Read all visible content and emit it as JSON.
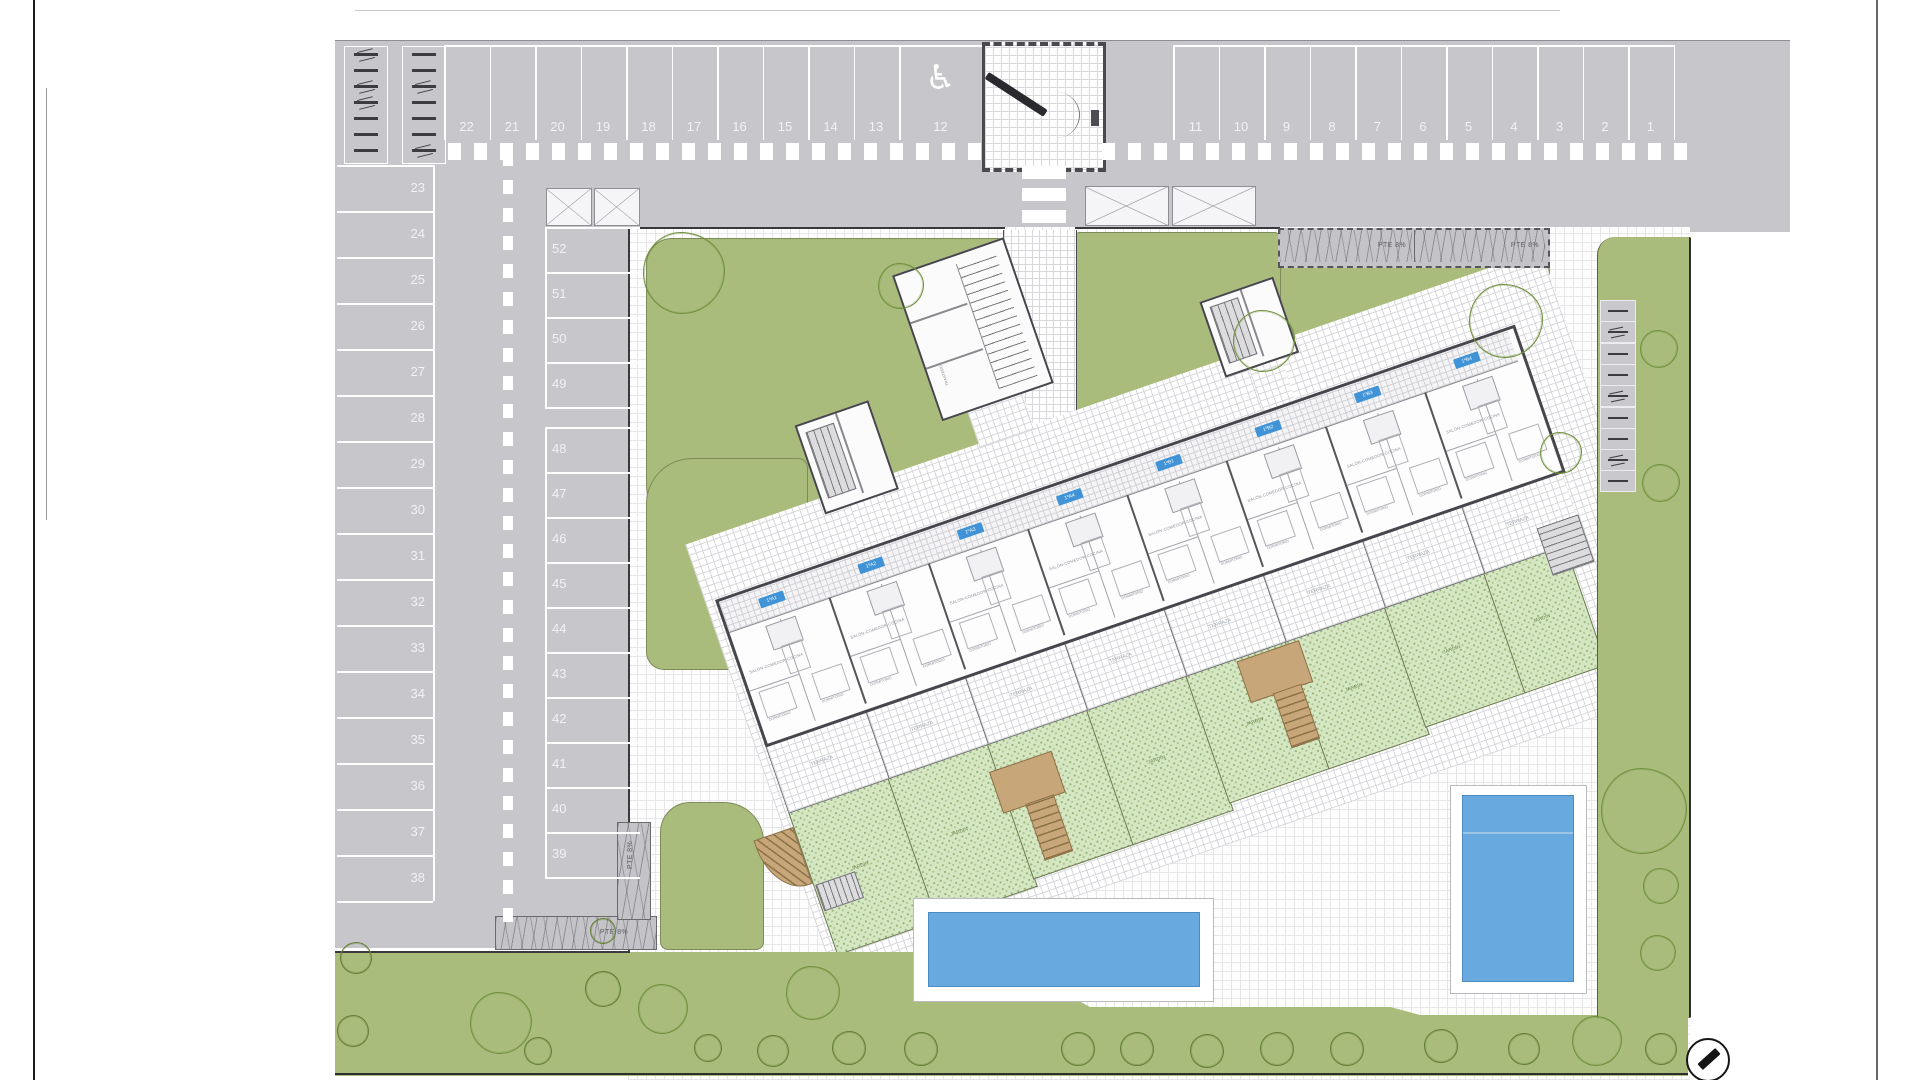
{
  "drawing": {
    "parking": {
      "top_left_numbers": [
        "22",
        "21",
        "20",
        "19",
        "18",
        "17",
        "16",
        "15",
        "14",
        "13"
      ],
      "accessible_number": "12",
      "accessible_icon": "♿",
      "top_right_numbers": [
        "11",
        "10",
        "9",
        "8",
        "7",
        "6",
        "5",
        "4",
        "3",
        "2",
        "1"
      ],
      "left_column_numbers": [
        "23",
        "24",
        "25",
        "26",
        "27",
        "28",
        "29",
        "30",
        "31",
        "32",
        "33",
        "34",
        "35",
        "36",
        "37",
        "38"
      ],
      "right_column_upper_numbers": [
        "52",
        "51",
        "50",
        "49"
      ],
      "right_column_lower_numbers": [
        "48",
        "47",
        "46",
        "45",
        "44",
        "43",
        "42",
        "41",
        "40",
        "39"
      ]
    },
    "ramps": {
      "label": "PTE 8%"
    },
    "building": {
      "unit_tags": [
        "1ºA1",
        "1ºA2",
        "1ºA3",
        "1ºA4",
        "1ºB1",
        "1ºB2",
        "1ºB3",
        "1ºB4"
      ],
      "rooms": {
        "living": "SALÓN-COMEDOR-COCINA",
        "bedroom": "DORMITORIO",
        "terrace": "TERRAZA",
        "garden": "JARDÍN",
        "storage": "TRASTEROS"
      }
    },
    "compass": {
      "icon": "north-arrow"
    }
  }
}
